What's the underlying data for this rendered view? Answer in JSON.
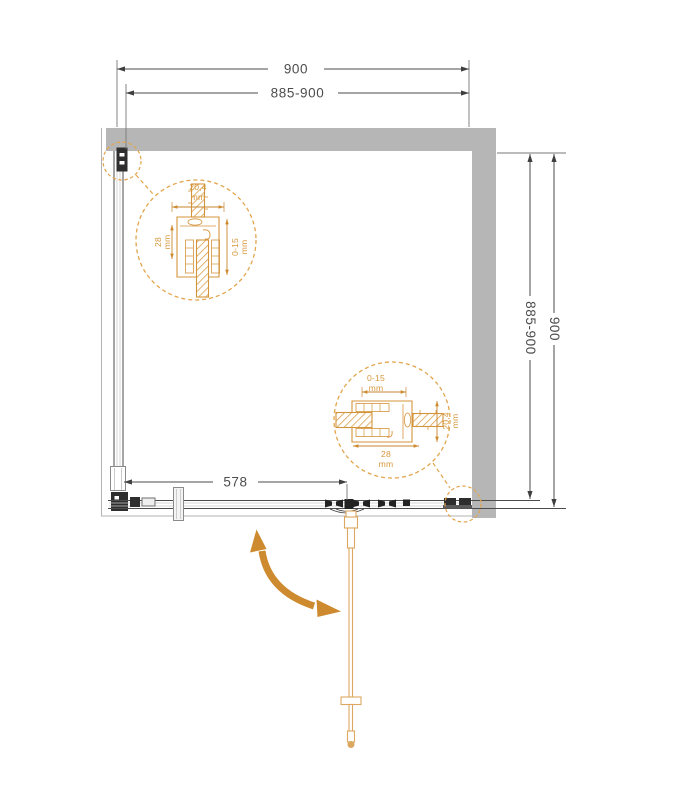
{
  "dims": {
    "top_width": "900",
    "top_width_adjust": "885-900",
    "right_depth": "900",
    "right_depth_adjust": "885-900",
    "door_opening": "578"
  },
  "detail_top_left": {
    "profile_width": "20,4",
    "profile_depth": "28",
    "adjust_range": "0-15",
    "unit": "mm"
  },
  "detail_bottom_right": {
    "profile_width": "20,4",
    "profile_depth": "28",
    "adjust_range": "0-15",
    "unit": "mm"
  },
  "colors": {
    "wall_gray": "#B6B6B6",
    "line_dark": "#4B4B4B",
    "accent_orange": "#DA9C42",
    "arrow_orange": "#CE8A2E"
  }
}
